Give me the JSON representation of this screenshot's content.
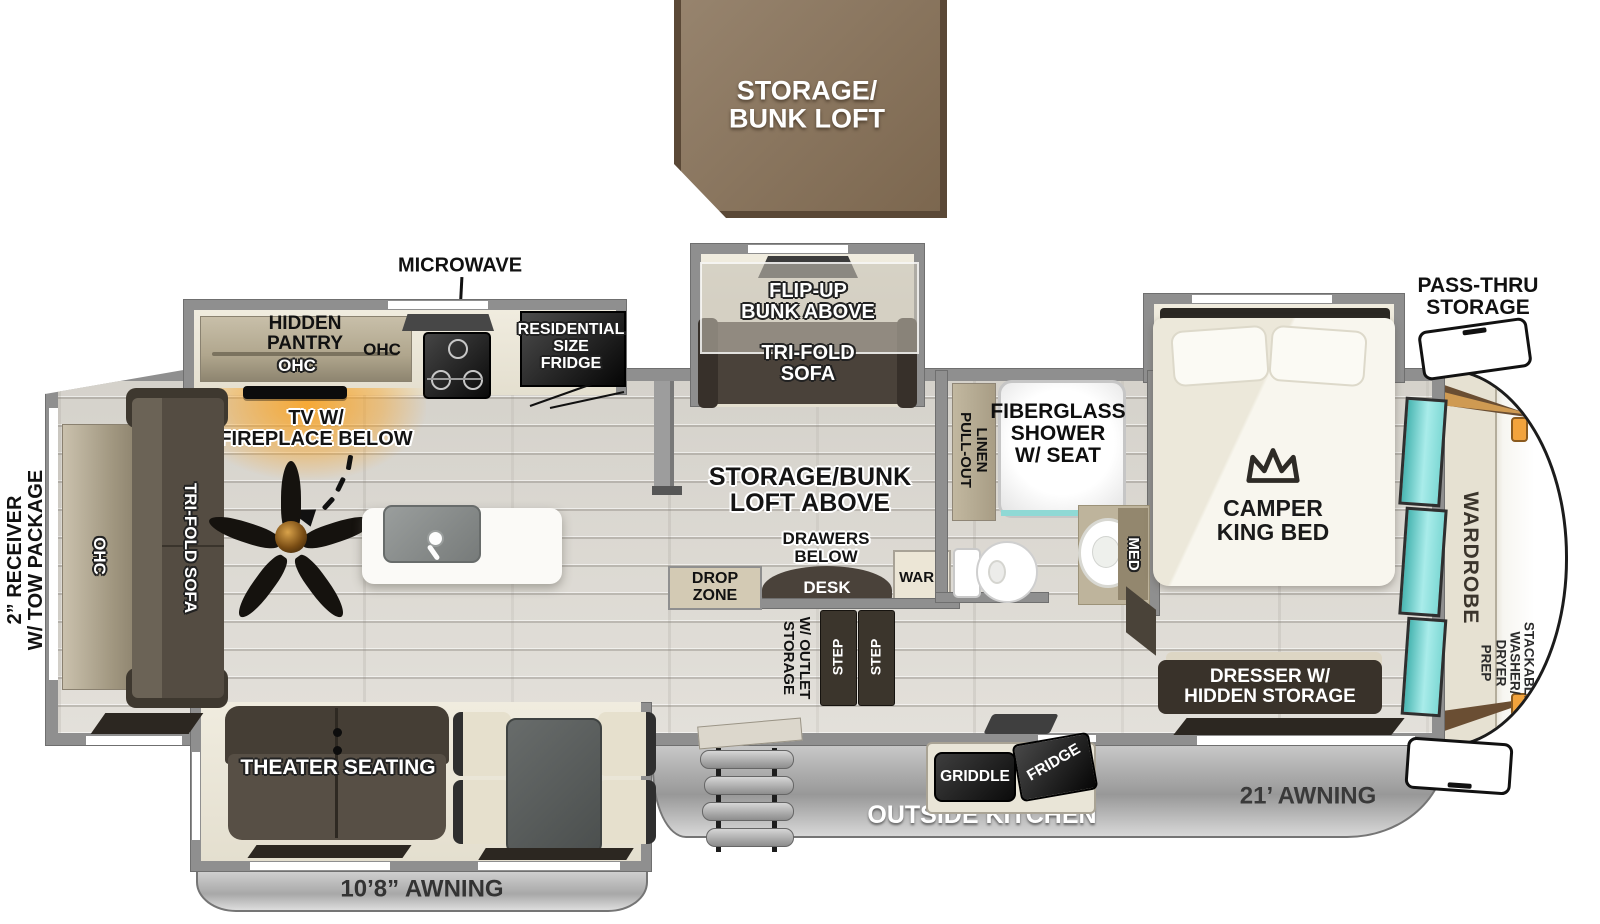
{
  "loft_box": {
    "line1": "STORAGE/",
    "line2": "BUNK LOFT"
  },
  "kitchen": {
    "microwave": "MICROWAVE",
    "hidden_pantry1": "HIDDEN",
    "hidden_pantry2": "PANTRY",
    "ohc_pantry": "OHC",
    "ohc_counter": "OHC",
    "fridge1": "RESIDENTIAL",
    "fridge2": "SIZE",
    "fridge3": "FRIDGE",
    "tv1": "TV W/",
    "tv2": "FIREPLACE BELOW"
  },
  "bunk": {
    "flip1": "FLIP-UP",
    "flip2": "BUNK ABOVE",
    "sofa1": "TRI-FOLD",
    "sofa2": "SOFA",
    "loft1": "STORAGE/BUNK",
    "loft2": "LOFT ABOVE",
    "drawers1": "DRAWERS",
    "drawers2": "BELOW",
    "desk": "DESK",
    "ward": "WARD",
    "drop1": "DROP",
    "drop2": "ZONE",
    "storage_outlet1": "STORAGE",
    "storage_outlet2": "W/ OUTLET",
    "step": "STEP"
  },
  "bath": {
    "linen1": "PULL-OUT",
    "linen2": "LINEN",
    "shower1": "FIBERGLASS",
    "shower2": "SHOWER",
    "shower3": "W/ SEAT",
    "med": "MED"
  },
  "bedroom": {
    "king1": "CAMPER",
    "king2": "KING BED",
    "dresser1": "DRESSER W/",
    "dresser2": "HIDDEN STORAGE",
    "wardrobe": "WARDROBE",
    "washer1": "STACKABLE",
    "washer2": "WASHER/",
    "washer3": "DRYER",
    "washer4": "PREP",
    "pass1": "PASS-THRU",
    "pass2": "STORAGE"
  },
  "living": {
    "ohc": "OHC",
    "sofa": "TRI-FOLD SOFA",
    "theater": "THEATER SEATING"
  },
  "exterior": {
    "receiver1": "2” RECEIVER",
    "receiver2": "W/ TOW PACKAGE",
    "awning_rear": "10’8” AWNING",
    "awning_main": "21’ AWNING",
    "outside_kitchen": "OUTSIDE KITCHEN",
    "griddle": "GRIDDLE",
    "fridge": "FRIDGE"
  },
  "colors": {
    "wall_gray": "#8f8f8f",
    "floor_wood": "#dcd9d3",
    "slide_floor": "#ece8db",
    "furniture_dark": "#4b433a",
    "loft_brown": "#8a775f",
    "window_teal": "#7fd9d5",
    "fireplace_glow": "#f5a42c",
    "awning_gray": "#b5b5b5"
  }
}
